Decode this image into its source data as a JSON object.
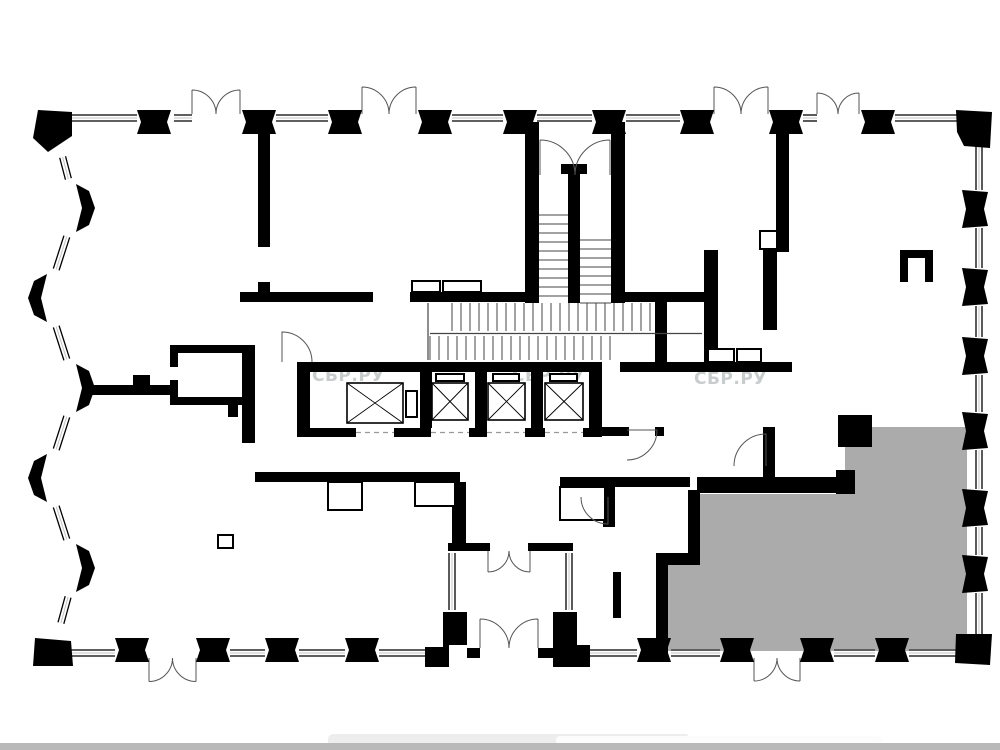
{
  "page": {
    "background": "#ffffff",
    "description": "apartment floor plan drawing"
  },
  "watermark": {
    "text": "СБР.РУ",
    "color": "#c3c7c8",
    "opacity": 0.9,
    "font_size": 17,
    "positions": [
      [
        312,
        381
      ],
      [
        512,
        381
      ],
      [
        694,
        384
      ]
    ]
  },
  "plan": {
    "wall_color": "#000000",
    "window_mid_color": "#c4c4c4",
    "tread_color": "#444444",
    "door_color": "#555555",
    "highlight_unit": {
      "color": "#ababab",
      "points": "845,427 967,427 967,651 668,651 668,565 700,565 700,494 845,494"
    },
    "piers": {
      "top_y": 110,
      "top_x": [
        137,
        242,
        328,
        418,
        503,
        592,
        680,
        769,
        861
      ],
      "bottom_y": 638,
      "bottom_x": [
        115,
        196,
        265,
        345,
        637,
        720,
        800,
        875
      ],
      "right_x": 962,
      "right_y": [
        190,
        268,
        337,
        412,
        489,
        555
      ],
      "left": [
        {
          "x": 76,
          "y": 208,
          "dir": 1
        },
        {
          "x": 47,
          "y": 298,
          "dir": -1
        },
        {
          "x": 76,
          "y": 388,
          "dir": 1
        },
        {
          "x": 47,
          "y": 478,
          "dir": -1
        },
        {
          "x": 76,
          "y": 568,
          "dir": 1
        }
      ],
      "corners": [
        "M38,110 L72,112 L72,136 L48,152 L33,138 Z",
        "M956,110 L992,112 L990,148 L964,146 L957,132 Z",
        "M956,634 L992,634 L990,665 L955,663 Z",
        "M35,638 L71,641 L73,666 L33,666 Z"
      ]
    },
    "windows": {
      "segments": [
        [
          70,
          118,
          137,
          118
        ],
        [
          174,
          118,
          192,
          118
        ],
        [
          276,
          118,
          328,
          118
        ],
        [
          452,
          118,
          503,
          118
        ],
        [
          537,
          118,
          592,
          118
        ],
        [
          626,
          118,
          680,
          118
        ],
        [
          803,
          118,
          817,
          118
        ],
        [
          895,
          118,
          958,
          118
        ],
        [
          979,
          146,
          979,
          190
        ],
        [
          979,
          228,
          979,
          268
        ],
        [
          979,
          306,
          979,
          337
        ],
        [
          979,
          375,
          979,
          412
        ],
        [
          979,
          450,
          979,
          489
        ],
        [
          979,
          527,
          979,
          555
        ],
        [
          979,
          593,
          979,
          635
        ],
        [
          71,
          653,
          115,
          653
        ],
        [
          230,
          653,
          265,
          653
        ],
        [
          299,
          653,
          345,
          653
        ],
        [
          379,
          653,
          433,
          653
        ],
        [
          590,
          653,
          637,
          653
        ],
        [
          671,
          653,
          720,
          653
        ],
        [
          834,
          653,
          875,
          653
        ],
        [
          909,
          653,
          958,
          653
        ],
        [
          452,
          553,
          452,
          610
        ],
        [
          569,
          553,
          569,
          610
        ]
      ],
      "left_outline": [
        [
          55,
          128
        ],
        [
          76,
          208
        ],
        [
          47,
          298
        ],
        [
          76,
          388
        ],
        [
          47,
          478
        ],
        [
          76,
          568
        ],
        [
          53,
          652
        ]
      ]
    },
    "walls": [
      [
        258,
        122,
        12,
        125
      ],
      [
        258,
        282,
        12,
        20
      ],
      [
        240,
        292,
        133,
        10
      ],
      [
        410,
        292,
        115,
        10
      ],
      [
        625,
        292,
        87,
        10
      ],
      [
        525,
        122,
        14,
        181
      ],
      [
        611,
        122,
        14,
        181
      ],
      [
        568,
        172,
        12,
        131
      ],
      [
        561,
        164,
        26,
        10
      ],
      [
        655,
        292,
        12,
        80
      ],
      [
        704,
        250,
        14,
        122
      ],
      [
        763,
        250,
        14,
        80
      ],
      [
        776,
        122,
        13,
        130
      ],
      [
        620,
        362,
        172,
        10
      ],
      [
        297,
        362,
        305,
        10
      ],
      [
        297,
        362,
        13,
        75
      ],
      [
        589,
        362,
        13,
        75
      ],
      [
        420,
        372,
        12,
        56
      ],
      [
        475,
        372,
        12,
        56
      ],
      [
        531,
        372,
        12,
        56
      ],
      [
        297,
        428,
        305,
        9
      ],
      [
        255,
        472,
        205,
        10
      ],
      [
        452,
        482,
        14,
        62
      ],
      [
        560,
        477,
        130,
        10
      ],
      [
        603,
        487,
        12,
        40
      ],
      [
        688,
        490,
        12,
        75
      ],
      [
        656,
        553,
        44,
        12
      ],
      [
        656,
        565,
        12,
        88
      ],
      [
        697,
        477,
        148,
        16
      ],
      [
        836,
        470,
        19,
        24
      ],
      [
        838,
        415,
        34,
        32
      ],
      [
        600,
        427,
        29,
        9
      ],
      [
        655,
        427,
        9,
        9
      ],
      [
        763,
        427,
        12,
        66
      ],
      [
        613,
        572,
        8,
        46
      ],
      [
        87,
        385,
        85,
        10
      ],
      [
        133,
        375,
        17,
        10
      ],
      [
        170,
        345,
        80,
        8
      ],
      [
        242,
        345,
        13,
        98
      ],
      [
        170,
        397,
        80,
        8
      ],
      [
        170,
        345,
        8,
        22
      ],
      [
        170,
        380,
        8,
        25
      ],
      [
        228,
        405,
        10,
        12
      ],
      [
        448,
        543,
        42,
        8
      ],
      [
        528,
        543,
        45,
        8
      ],
      [
        467,
        648,
        13,
        10
      ],
      [
        538,
        648,
        15,
        10
      ],
      [
        900,
        250,
        33,
        8
      ],
      [
        900,
        250,
        8,
        32
      ],
      [
        925,
        250,
        8,
        32
      ]
    ],
    "white_gaps": [
      [
        356,
        428,
        38,
        9
      ],
      [
        431,
        428,
        38,
        9
      ],
      [
        487,
        428,
        38,
        9
      ],
      [
        545,
        428,
        38,
        9
      ]
    ],
    "door_gap_dashes": [
      [
        356,
        432.5,
        394,
        432.5
      ],
      [
        431,
        432.5,
        469,
        432.5
      ],
      [
        487,
        432.5,
        525,
        432.5
      ],
      [
        545,
        432.5,
        583,
        432.5
      ]
    ],
    "outline_boxes": [
      [
        412,
        281,
        28,
        11
      ],
      [
        443,
        281,
        38,
        11
      ],
      [
        436,
        374,
        28,
        7
      ],
      [
        493,
        374,
        26,
        7
      ],
      [
        550,
        374,
        27,
        7
      ],
      [
        406,
        391,
        11,
        26
      ],
      [
        708,
        349,
        26,
        13
      ],
      [
        737,
        349,
        24,
        13
      ],
      [
        760,
        231,
        17,
        18
      ],
      [
        328,
        482,
        34,
        28
      ],
      [
        415,
        482,
        40,
        24
      ],
      [
        560,
        487,
        45,
        33
      ],
      [
        218,
        535,
        15,
        13
      ]
    ],
    "l_piers": [
      "M443,612 L467,612 L467,645 L449,645 L449,667 L425,667 L425,647 L443,647 Z",
      "M553,612 L577,612 L577,645 L590,645 L590,667 L553,667 Z"
    ],
    "elevators": [
      [
        347,
        383,
        56,
        40
      ],
      [
        432,
        383,
        36,
        37
      ],
      [
        488,
        383,
        37,
        37
      ],
      [
        545,
        383,
        38,
        37
      ]
    ],
    "double_doors": [
      {
        "x1": 192,
        "x2": 240,
        "y": 114,
        "dir": -1
      },
      {
        "x1": 362,
        "x2": 416,
        "y": 114,
        "dir": -1
      },
      {
        "x1": 714,
        "x2": 768,
        "y": 114,
        "dir": -1
      },
      {
        "x1": 817,
        "x2": 859,
        "y": 114,
        "dir": -1
      },
      {
        "x1": 149,
        "x2": 196,
        "y": 658,
        "dir": 1
      },
      {
        "x1": 754,
        "x2": 800,
        "y": 658,
        "dir": 1
      },
      {
        "x1": 488,
        "x2": 530,
        "y": 551,
        "dir": 1
      },
      {
        "x1": 480,
        "x2": 538,
        "y": 648,
        "dir": -1
      },
      {
        "x1": 540,
        "x2": 610,
        "y": 175,
        "dir": -1
      }
    ],
    "single_door_paths": [
      "M282,362 L282,332 A30,30 0 0 1 312,362",
      "M627,430 L657,430 M657,430 A30,30 0 0 1 627,460",
      "M766,466 L766,434 A32,32 0 0 0 734,466",
      "M608,497 L608,524 A27,27 0 0 1 581,497"
    ],
    "stairs": {
      "runs": [
        {
          "o": "h",
          "x1": 539,
          "x2": 568,
          "p0": 215,
          "n": 10,
          "step": 9
        },
        {
          "o": "h",
          "x1": 580,
          "x2": 611,
          "p0": 240,
          "n": 8,
          "step": 9
        },
        {
          "o": "v",
          "y1": 303,
          "y2": 331,
          "p0": 452,
          "n": 23,
          "step": 9
        },
        {
          "o": "v",
          "y1": 336,
          "y2": 360,
          "p0": 430,
          "n": 21,
          "step": 9
        }
      ],
      "lines": [
        [
          430,
          333.5,
          702,
          333.5
        ],
        [
          428,
          303,
          428,
          360
        ]
      ]
    }
  },
  "bottom_ui": {
    "bar_color": "#b9b9b9",
    "tab_color": "#ededed",
    "tab_inner_color": "#fcfcfc"
  }
}
